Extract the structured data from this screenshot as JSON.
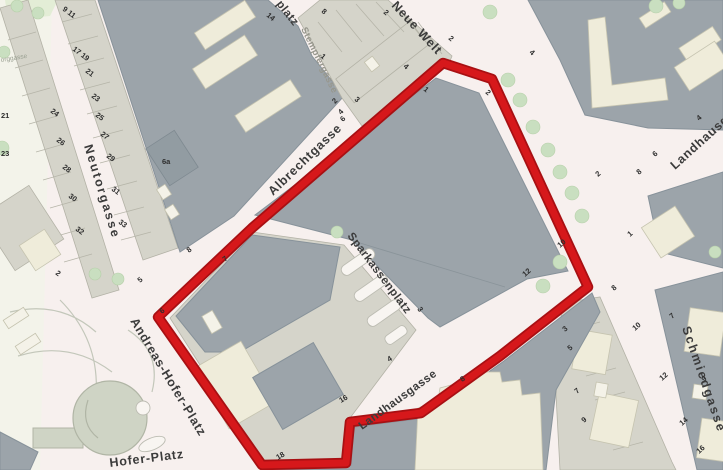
{
  "map": {
    "description": "City plan of Graz inner district with red boundary around the Sparkassenplatz / Landhausgasse block",
    "street_labels": [
      "Neutorgasse",
      "Albrechtgasse",
      "Sparkassenplatz",
      "Landhausgasse",
      "Landhausgasse",
      "Neue Welt",
      "Stempfergasse",
      "Schmiedgasse",
      "Andreas-Hofer-Platz",
      "Hofer-Platz",
      "platz",
      "orggasse"
    ],
    "house_numbers": [
      "9 11",
      "17 19",
      "21",
      "23",
      "25",
      "27",
      "29",
      "31",
      "33",
      "24",
      "26",
      "28",
      "30",
      "32",
      "2",
      "21",
      "23",
      "14",
      "6a",
      "1",
      "3",
      "8",
      "2",
      "2",
      "4",
      "4",
      "1",
      "2",
      "2",
      "4",
      "6",
      "8",
      "5",
      "6",
      "7",
      "3",
      "4",
      "16",
      "18",
      "8",
      "4",
      "6",
      "8",
      "2",
      "1",
      "10",
      "12",
      "8",
      "10",
      "12",
      "14",
      "16",
      "7",
      "9",
      "3",
      "5",
      "7",
      "9"
    ],
    "colors": {
      "boundary_red": "#d6181b",
      "boundary_red_dark": "#a81013",
      "building_gray": "#9ca4aa",
      "building_beige": "#d5d4ca",
      "building_cream": "#efecda",
      "tree_green": "#c9dfc0",
      "road_pink": "#f7f0ee"
    }
  }
}
